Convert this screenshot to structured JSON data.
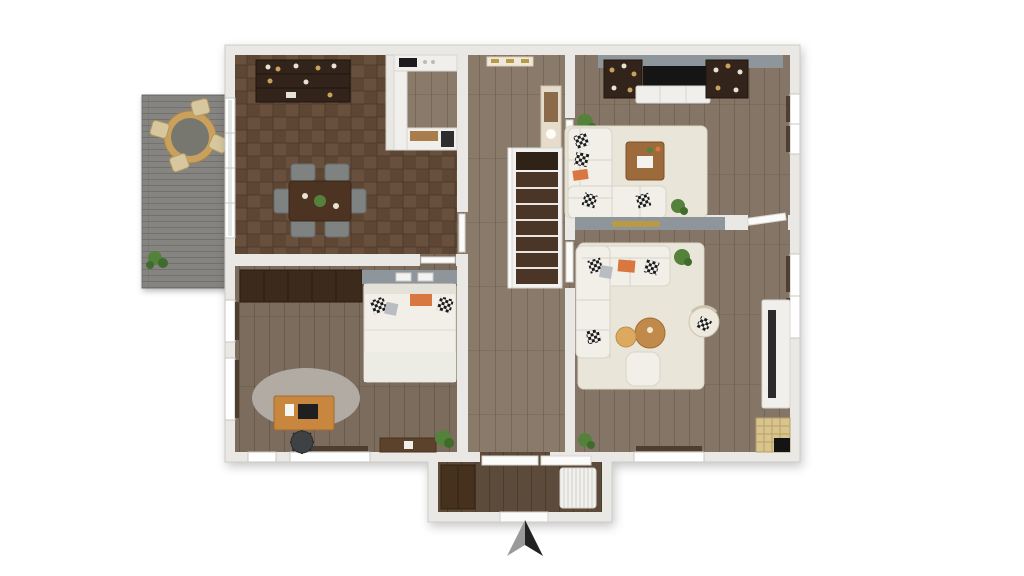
{
  "scene": {
    "type": "3d-floor-plan-render",
    "view": "top-down",
    "compass": "north-arrow-bottom-center"
  },
  "palette": {
    "wall": "#e9e8e5",
    "wall_edge": "#cfcdc9",
    "wall_bright": "#f7f6f4",
    "dining_floor": "#5e4634",
    "dining_floor_alt": "#68503c",
    "dining_line": "#4a3627",
    "hall_floor": "#8a7a6a",
    "hall_line": "#77675a",
    "right_floor": "#857566",
    "right_line": "#746455",
    "bed_floor": "#7c6c5d",
    "bed_line": "#6a5a4b",
    "vest_floor": "#5c4a3a",
    "vest_line": "#4c3c2e",
    "deck": "#868480",
    "deck_line": "#737170",
    "dark_wood": "#32241a",
    "dark_wood_edge": "#1f150d",
    "mid_wood": "#4c3322",
    "accent_wall": "#8e959b",
    "sofa": "#f1efe8",
    "sofa_line": "#d8d4c8",
    "rug": "#e9e5d9",
    "rug_edge": "#dcd7c7",
    "round_rug": "#b5b1aa",
    "desk_wood": "#c8863e",
    "coffee_wood": "#9c6a3b",
    "tan": "#c9a05c",
    "tan_light": "#dca95e",
    "plant": "#55823b",
    "plant_dark": "#3f6b2c",
    "orange": "#d8773f",
    "glass": "#e3e7e6",
    "sill": "#4e3e30",
    "tread": "#4a3526",
    "chair_gray": "#7e8280",
    "gray_pillow": "#b9bcc0",
    "gold": "#bb9a45",
    "black": "#141414",
    "door_white": "#fbfbfa",
    "counter_white": "#f0efec",
    "arrow_gray": "#9a9a9a",
    "arrow_dark": "#222222"
  },
  "rooms": [
    {
      "id": "deck",
      "name": "outdoor deck",
      "furniture": [
        "round-table",
        "deck-chairs-x4",
        "potted-plant"
      ]
    },
    {
      "id": "dining-room",
      "name": "dining room",
      "furniture": [
        "bar-sideboard",
        "dining-table",
        "chairs-x6",
        "centerpiece-plant"
      ]
    },
    {
      "id": "kitchen-nook",
      "name": "kitchen nook",
      "furniture": [
        "counter-cooktop",
        "side-counter",
        "counter-oven"
      ]
    },
    {
      "id": "hallway",
      "name": "hallway with staircase",
      "furniture": [
        "coat-rack",
        "tall-cabinet",
        "staircase"
      ]
    },
    {
      "id": "living-room",
      "name": "living room (top right)",
      "furniture": [
        "bookshelf-left",
        "tv",
        "tv-console",
        "bookshelf-right",
        "corner-sofa",
        "coffee-table",
        "rug",
        "plants-x2",
        "pillows"
      ]
    },
    {
      "id": "family-room",
      "name": "family room (bottom right)",
      "furniture": [
        "corner-sofa",
        "round-coffee-tables-x2",
        "ottoman",
        "wicker-chair",
        "rug",
        "media-console",
        "cat-tree",
        "potted-plant"
      ]
    },
    {
      "id": "bedroom-office",
      "name": "bedroom / office",
      "furniture": [
        "wardrobe",
        "bed",
        "desk",
        "desk-chair",
        "round-rug",
        "low-shelf",
        "potted-plant"
      ]
    },
    {
      "id": "vestibule",
      "name": "entry vestibule",
      "furniture": [
        "closet",
        "radiator",
        "entry-door"
      ]
    }
  ],
  "compass": {
    "type": "north-arrow"
  }
}
